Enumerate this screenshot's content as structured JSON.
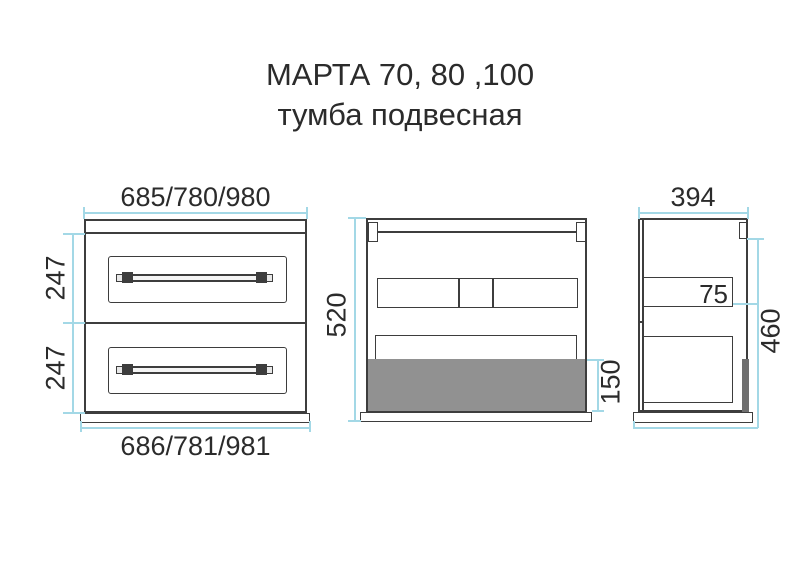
{
  "title": {
    "line1": "МАРТА 70, 80 ,100",
    "line2": "тумба подвесная"
  },
  "colors": {
    "outline": "#3d3d3d",
    "dimension_line": "#a3d8e6",
    "text": "#2b2b2b",
    "back_panel_gray": "#919191",
    "side_panel_dark": "#6f6f6f",
    "background": "#ffffff"
  },
  "front_view": {
    "dim_width_top": "685/780/980",
    "dim_width_bottom": "686/781/981",
    "dim_drawer_top": "247",
    "dim_drawer_bottom": "247"
  },
  "back_view": {
    "dim_height": "520",
    "dim_bottom_panel": "150"
  },
  "side_view": {
    "dim_depth": "394",
    "dim_apron": "75",
    "dim_height": "460"
  }
}
